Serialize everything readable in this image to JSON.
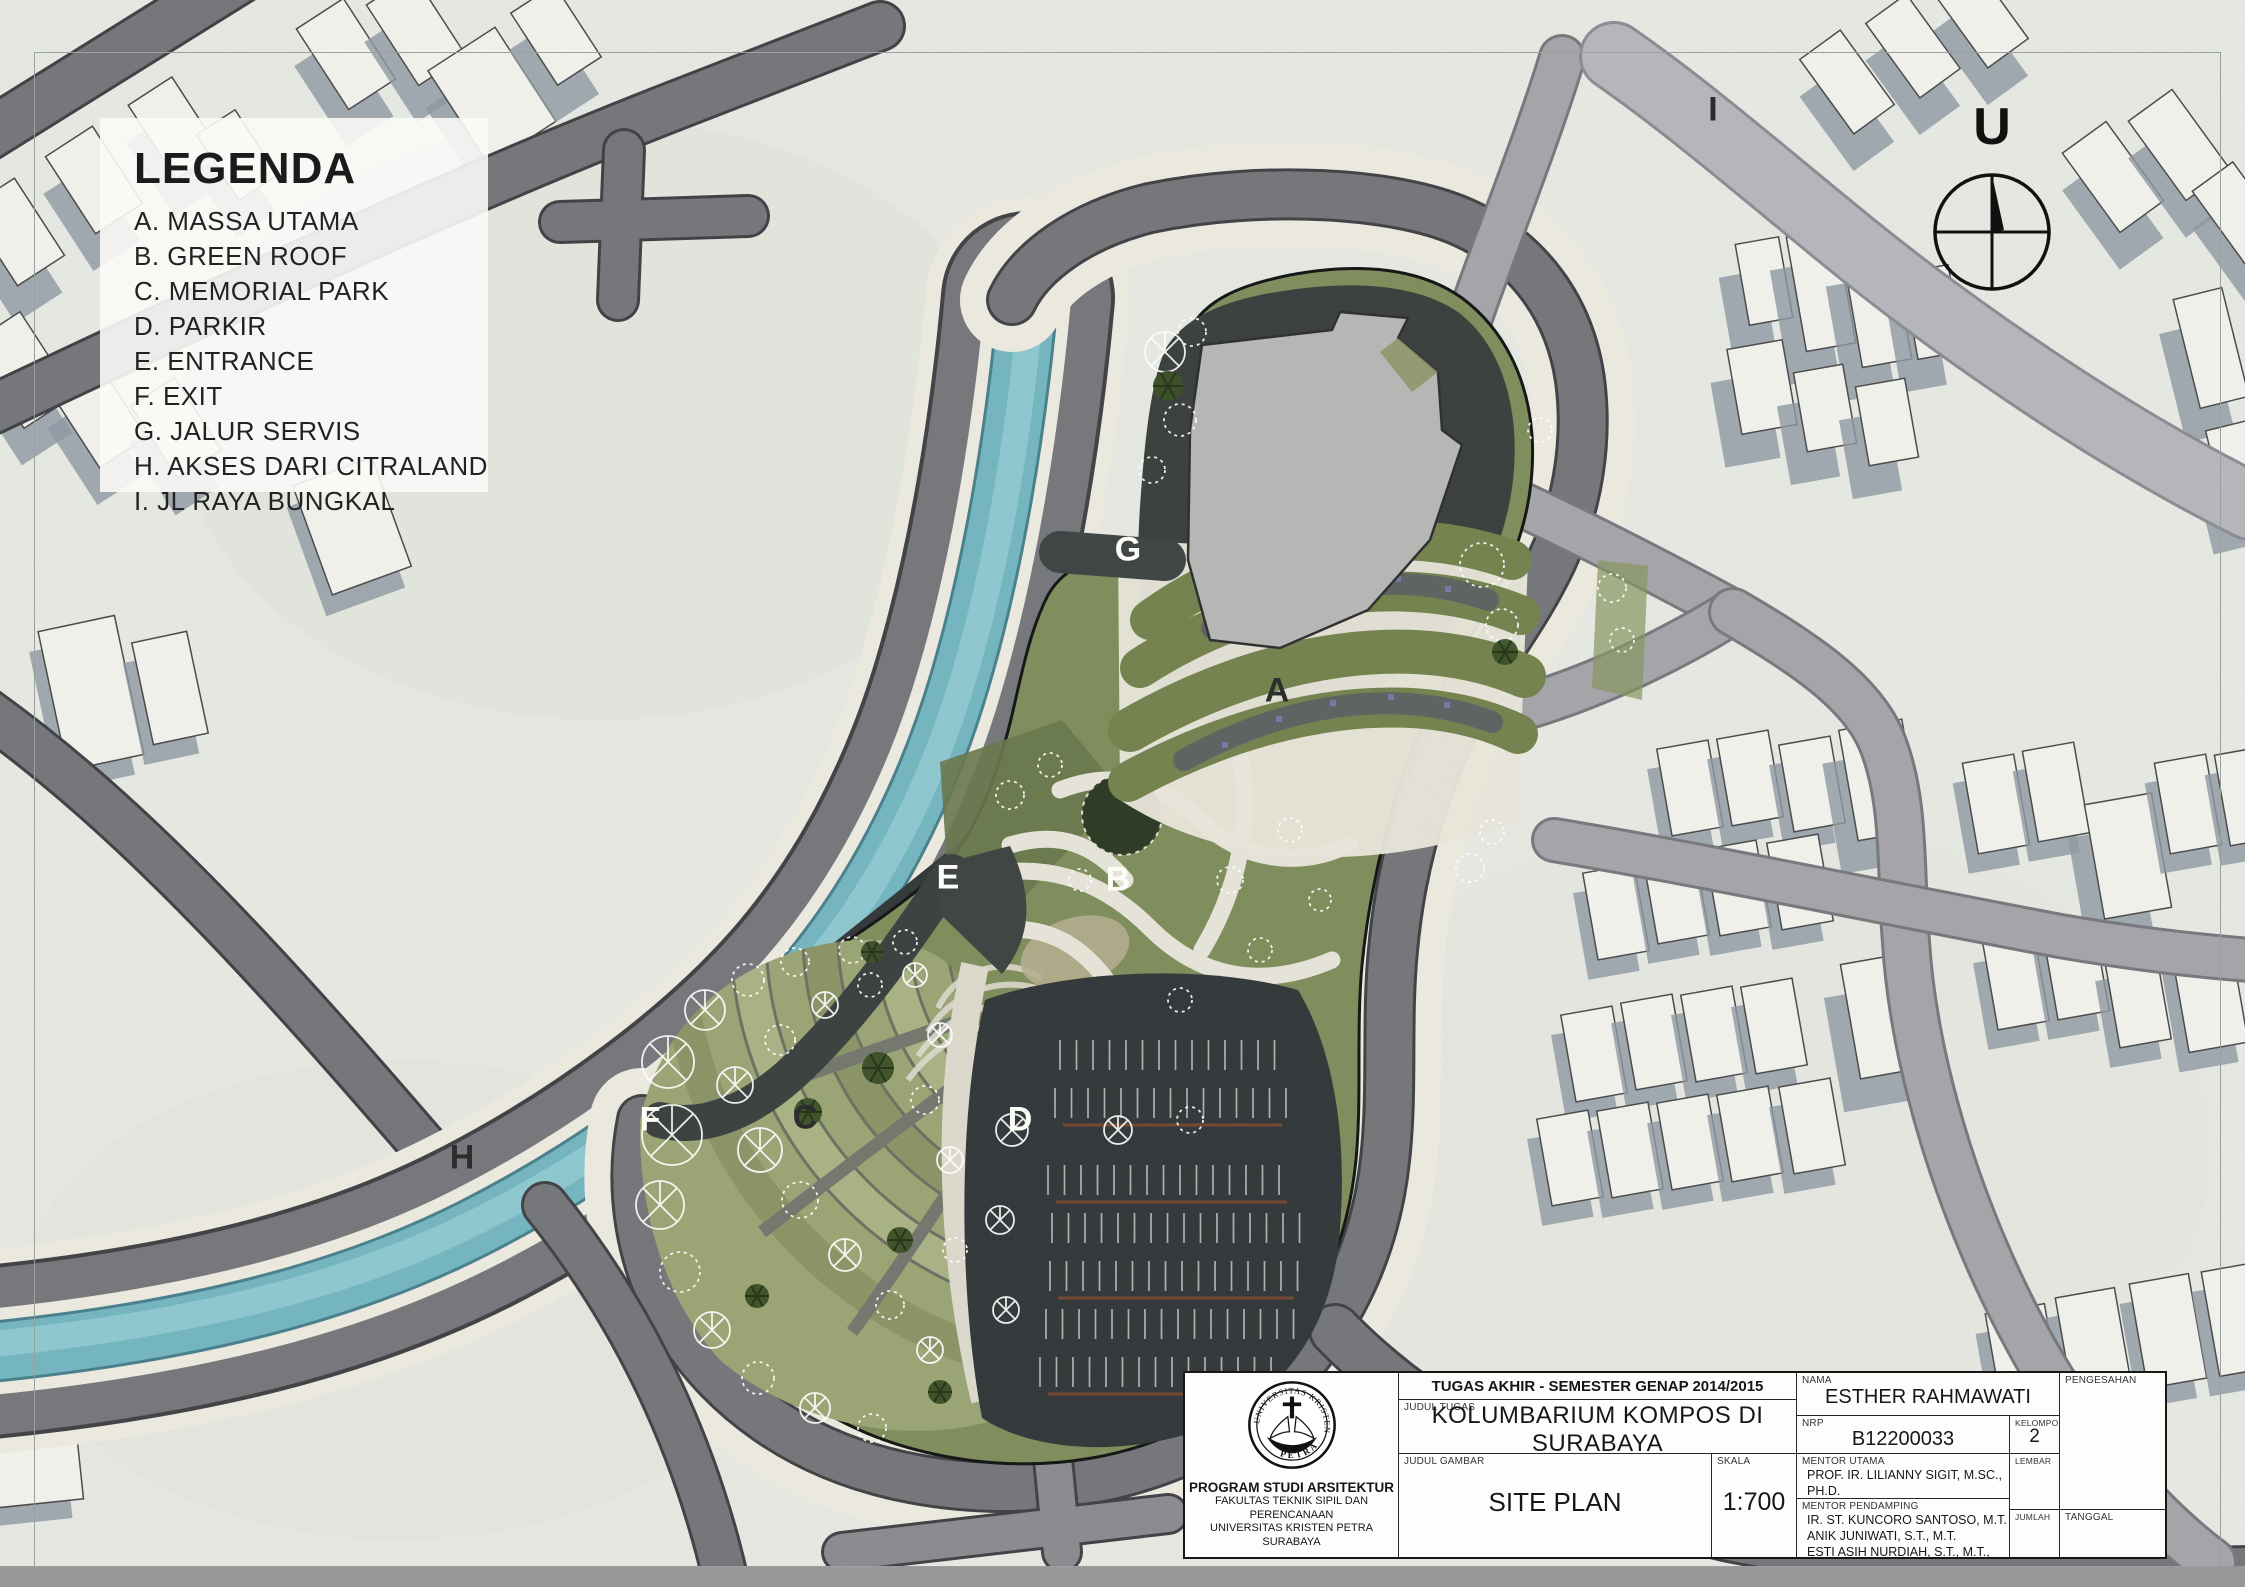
{
  "legend": {
    "title": "LEGENDA",
    "items": [
      "A. MASSA UTAMA",
      "B. GREEN ROOF",
      "C. MEMORIAL PARK",
      "D. PARKIR",
      "E. ENTRANCE",
      "F. EXIT",
      "G. JALUR SERVIS",
      "H. AKSES DARI CITRALAND",
      "I. JL RAYA BUNGKAL"
    ]
  },
  "map_labels": {
    "a": "A",
    "b": "B",
    "c": "C",
    "d": "D",
    "e": "E",
    "f": "F",
    "g": "G",
    "h": "H",
    "i": "I"
  },
  "north_arrow": {
    "label": "U"
  },
  "title_block": {
    "header": "TUGAS AKHIR - SEMESTER GENAP 2014/2015",
    "judul_tugas_label": "JUDUL TUGAS",
    "judul_tugas": "KOLUMBARIUM KOMPOS DI SURABAYA",
    "judul_gambar_label": "JUDUL GAMBAR",
    "judul_gambar": "SITE PLAN",
    "skala_label": "SKALA",
    "skala": "1:700",
    "nama_label": "NAMA",
    "nama": "ESTHER RAHMAWATI",
    "nrp_label": "NRP",
    "nrp": "B12200033",
    "kelompok_label": "KELOMPOK",
    "kelompok": "2",
    "mentor_utama_label": "MENTOR UTAMA",
    "mentor_utama": "PROF. IR. LILIANNY SIGIT, M.SC., PH.D.",
    "mentor_pendamping_label": "MENTOR PENDAMPING",
    "mentor_pendamping": [
      "IR. ST. KUNCORO SANTOSO, M.T.",
      "ANIK JUNIWATI, S.T., M.T.",
      "ESTI ASIH NURDIAH, S.T., M.T., PH.D."
    ],
    "pengesahan_label": "PENGESAHAN",
    "lembar_label": "LEMBAR",
    "jumlah_label": "JUMLAH",
    "tanggal_label": "TANGGAL",
    "institution": {
      "seal_top": "UNIVERSITAS KRISTEN",
      "seal_bottom": "PETRA",
      "program": "PROGRAM STUDI ARSITEKTUR",
      "faculty": "FAKULTAS TEKNIK SIPIL DAN PERENCANAAN",
      "university": "UNIVERSITAS KRISTEN PETRA",
      "city": "SURABAYA"
    }
  },
  "colors": {
    "paper": "#e8eae4",
    "road_dark": "#75767a",
    "road_medium": "#a4a4a9",
    "road_light": "#b6b5bb",
    "river": "#74b5c0",
    "site_grass": "#7f8d5c",
    "memorial_green": "#9aa474",
    "asphalt_dark": "#3a3f3e",
    "building_gray": "#b6b7b5",
    "shadow_blue": "#8d97a3"
  }
}
